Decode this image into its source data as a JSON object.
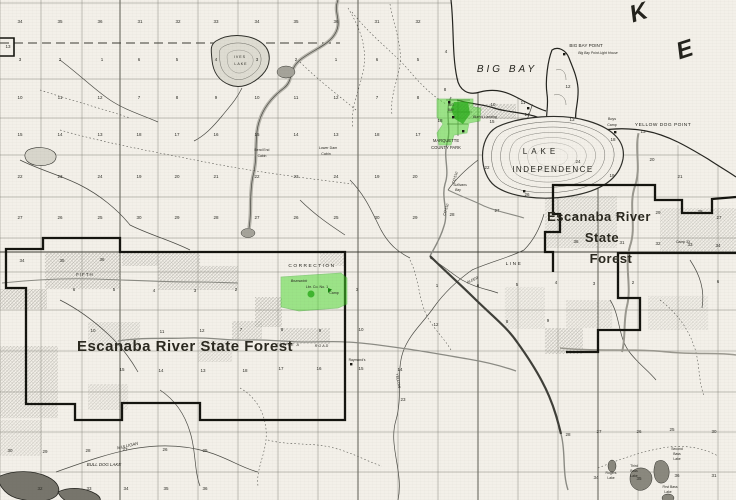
{
  "map": {
    "colors": {
      "paper": "#f3f0e9",
      "ink": "#26251f",
      "highlight_green": "#46d728",
      "highlight_green_dark": "#28aa19",
      "boundary_black": "#14140f",
      "shade_gray": "#8e8d86"
    },
    "labels": [
      {
        "t": "K",
        "x": 641,
        "y": 20,
        "s": 24,
        "it": true,
        "rot": -18,
        "cls": "big"
      },
      {
        "t": "E",
        "x": 687,
        "y": 57,
        "s": 24,
        "it": true,
        "rot": -18,
        "cls": "big"
      },
      {
        "t": "BIG  BAY",
        "x": 507,
        "y": 72,
        "s": 10,
        "it": true,
        "ls": 3
      },
      {
        "t": "BIG BAY POINT",
        "x": 586,
        "y": 47,
        "s": 4.6
      },
      {
        "t": "Big Bay Point Light House",
        "x": 598,
        "y": 54,
        "s": 3.4,
        "it": true
      },
      {
        "t": "Burn's Landing",
        "x": 485,
        "y": 118,
        "s": 3.6,
        "it": true
      },
      {
        "t": "YELLOW DOG POINT",
        "x": 663,
        "y": 126,
        "s": 4.8,
        "ls": 0.5
      },
      {
        "t": "Boys",
        "x": 612,
        "y": 120,
        "s": 3.6
      },
      {
        "t": "Camp",
        "x": 612,
        "y": 126,
        "s": 3.6
      },
      {
        "t": "LAKE",
        "x": 541,
        "y": 154,
        "s": 8,
        "ls": 4
      },
      {
        "t": "INDEPENDENCE",
        "x": 553,
        "y": 172,
        "s": 8,
        "ls": 1.5
      },
      {
        "t": "MARQUETTE",
        "x": 446,
        "y": 142,
        "s": 4.2
      },
      {
        "t": "COUNTY PARK",
        "x": 446,
        "y": 149,
        "s": 4.2
      },
      {
        "t": "Lower Dam",
        "x": 328,
        "y": 149,
        "s": 3.6
      },
      {
        "t": "Cabin",
        "x": 326,
        "y": 155,
        "s": 3.6
      },
      {
        "t": "Bend End",
        "x": 262,
        "y": 151,
        "s": 3.4
      },
      {
        "t": "Cabin",
        "x": 262,
        "y": 157,
        "s": 3.4
      },
      {
        "t": "IVES",
        "x": 240,
        "y": 58,
        "s": 3.6,
        "ls": 1
      },
      {
        "t": "LAKE",
        "x": 241,
        "y": 65,
        "s": 3.6,
        "ls": 1
      },
      {
        "t": "Sullivans",
        "x": 460,
        "y": 186,
        "s": 3.4,
        "it": true
      },
      {
        "t": "Bay",
        "x": 458,
        "y": 191,
        "s": 3.4,
        "it": true
      },
      {
        "t": "CO 510",
        "x": 456,
        "y": 178,
        "s": 3.6,
        "rot": -72
      },
      {
        "t": "CO 510",
        "x": 447,
        "y": 210,
        "s": 3.6,
        "rot": -72
      },
      {
        "t": "CORRECTION",
        "x": 312,
        "y": 267,
        "s": 4.8,
        "ls": 1.5
      },
      {
        "t": "LINE",
        "x": 514,
        "y": 265,
        "s": 4.8,
        "ls": 1.5
      },
      {
        "t": "FIFTH",
        "x": 85,
        "y": 276,
        "s": 4.4,
        "ls": 1
      },
      {
        "t": "Escanaba River State Forest",
        "x": 185,
        "y": 351,
        "s": 15,
        "cls": "forest"
      },
      {
        "t": "Escanaba River",
        "x": 599,
        "y": 221,
        "s": 13,
        "cls": "forest"
      },
      {
        "t": "State",
        "x": 602,
        "y": 242,
        "s": 13,
        "cls": "forest"
      },
      {
        "t": "Forest",
        "x": 611,
        "y": 263,
        "s": 13,
        "cls": "forest"
      },
      {
        "t": "TRIPLE A",
        "x": 288,
        "y": 346,
        "s": 3.6,
        "it": true,
        "ls": 1
      },
      {
        "t": "ROAD",
        "x": 322,
        "y": 347,
        "s": 3.6,
        "it": true,
        "ls": 1
      },
      {
        "t": "Raymond's",
        "x": 357,
        "y": 361,
        "s": 3.4
      },
      {
        "t": "YELLOW",
        "x": 397,
        "y": 381,
        "s": 3.6,
        "rot": 80
      },
      {
        "t": "ALDER",
        "x": 473,
        "y": 281,
        "s": 3.6,
        "it": true,
        "rot": -25
      },
      {
        "t": "MULLIGAN",
        "x": 128,
        "y": 447,
        "s": 4.2,
        "it": true,
        "rot": -13
      },
      {
        "t": "BULL DOG LAKE",
        "x": 104,
        "y": 466,
        "s": 4.4,
        "it": true
      },
      {
        "t": "Rogers",
        "x": 611,
        "y": 474,
        "s": 3.4
      },
      {
        "t": "Lake",
        "x": 611,
        "y": 479,
        "s": 3.4
      },
      {
        "t": "Third",
        "x": 634,
        "y": 467,
        "s": 3.4
      },
      {
        "t": "Bass",
        "x": 634,
        "y": 472,
        "s": 3.4
      },
      {
        "t": "Lake",
        "x": 634,
        "y": 477,
        "s": 3.4
      },
      {
        "t": "Second",
        "x": 677,
        "y": 450,
        "s": 3.4
      },
      {
        "t": "Bass",
        "x": 677,
        "y": 455,
        "s": 3.4
      },
      {
        "t": "Lake",
        "x": 677,
        "y": 460,
        "s": 3.4
      },
      {
        "t": "First Bass",
        "x": 670,
        "y": 488,
        "s": 3.4
      },
      {
        "t": "Lake",
        "x": 668,
        "y": 493,
        "s": 3.4
      },
      {
        "t": "BIG",
        "x": 451,
        "y": 106,
        "s": 3.2
      },
      {
        "t": "BAY",
        "x": 451,
        "y": 111,
        "s": 3.2
      },
      {
        "t": "Brunswick",
        "x": 299,
        "y": 282,
        "s": 3.6,
        "it": true
      },
      {
        "t": "Lbr. Co. No. 1",
        "x": 317,
        "y": 288,
        "s": 3.6
      },
      {
        "t": "Camp",
        "x": 334,
        "y": 294,
        "s": 3.6
      },
      {
        "t": "Camp 33",
        "x": 683,
        "y": 243,
        "s": 3.4
      }
    ],
    "sections": [
      [
        34,
        20,
        23
      ],
      [
        35,
        60,
        23
      ],
      [
        36,
        100,
        23
      ],
      [
        31,
        140,
        23
      ],
      [
        32,
        178,
        23
      ],
      [
        33,
        216,
        23
      ],
      [
        34,
        257,
        23
      ],
      [
        35,
        296,
        23
      ],
      [
        36,
        336,
        23
      ],
      [
        31,
        377,
        23
      ],
      [
        32,
        418,
        23
      ],
      [
        3,
        20,
        61
      ],
      [
        2,
        60,
        61
      ],
      [
        1,
        102,
        61
      ],
      [
        6,
        139,
        61
      ],
      [
        5,
        177,
        61
      ],
      [
        4,
        216,
        61
      ],
      [
        3,
        257,
        61
      ],
      [
        2,
        296,
        61
      ],
      [
        1,
        336,
        61
      ],
      [
        6,
        377,
        61
      ],
      [
        5,
        418,
        61
      ],
      [
        10,
        20,
        99
      ],
      [
        11,
        60,
        99
      ],
      [
        12,
        100,
        99
      ],
      [
        7,
        139,
        99
      ],
      [
        8,
        177,
        99
      ],
      [
        9,
        216,
        99
      ],
      [
        10,
        257,
        99
      ],
      [
        11,
        296,
        99
      ],
      [
        12,
        336,
        99
      ],
      [
        7,
        377,
        99
      ],
      [
        8,
        418,
        99
      ],
      [
        15,
        20,
        136
      ],
      [
        14,
        60,
        136
      ],
      [
        13,
        100,
        136
      ],
      [
        18,
        139,
        136
      ],
      [
        17,
        177,
        136
      ],
      [
        16,
        216,
        136
      ],
      [
        15,
        257,
        136
      ],
      [
        14,
        296,
        136
      ],
      [
        13,
        336,
        136
      ],
      [
        18,
        377,
        136
      ],
      [
        17,
        418,
        136
      ],
      [
        22,
        20,
        178
      ],
      [
        23,
        60,
        178
      ],
      [
        24,
        100,
        178
      ],
      [
        19,
        139,
        178
      ],
      [
        20,
        177,
        178
      ],
      [
        21,
        216,
        178
      ],
      [
        22,
        257,
        178
      ],
      [
        23,
        296,
        178
      ],
      [
        24,
        336,
        178
      ],
      [
        19,
        377,
        178
      ],
      [
        20,
        415,
        178
      ],
      [
        27,
        20,
        219
      ],
      [
        26,
        60,
        219
      ],
      [
        25,
        100,
        219
      ],
      [
        30,
        139,
        219
      ],
      [
        29,
        177,
        219
      ],
      [
        28,
        216,
        219
      ],
      [
        27,
        257,
        219
      ],
      [
        26,
        296,
        219
      ],
      [
        25,
        336,
        219
      ],
      [
        30,
        377,
        219
      ],
      [
        29,
        415,
        219
      ],
      [
        34,
        22,
        262
      ],
      [
        35,
        62,
        262
      ],
      [
        36,
        102,
        261
      ],
      [
        6,
        74,
        291
      ],
      [
        5,
        114,
        291
      ],
      [
        4,
        154,
        292
      ],
      [
        3,
        195,
        292
      ],
      [
        2,
        236,
        291
      ],
      [
        3,
        357,
        291
      ],
      [
        13,
        8,
        48
      ],
      [
        4,
        446,
        53
      ],
      [
        8,
        445,
        91
      ],
      [
        18,
        440,
        122
      ],
      [
        12,
        568,
        88
      ],
      [
        10,
        493,
        106
      ],
      [
        11,
        523,
        104
      ],
      [
        14,
        527,
        116
      ],
      [
        15,
        492,
        123
      ],
      [
        13,
        572,
        121
      ],
      [
        22,
        487,
        169
      ],
      [
        24,
        578,
        163
      ],
      [
        26,
        527,
        196
      ],
      [
        27,
        497,
        212
      ],
      [
        28,
        452,
        216
      ],
      [
        25,
        576,
        218
      ],
      [
        30,
        618,
        216
      ],
      [
        29,
        658,
        214
      ],
      [
        28,
        700,
        213
      ],
      [
        27,
        719,
        219
      ],
      [
        13,
        643,
        133
      ],
      [
        18,
        613,
        141
      ],
      [
        19,
        612,
        177
      ],
      [
        20,
        652,
        161
      ],
      [
        21,
        680,
        178
      ],
      [
        36,
        576,
        243
      ],
      [
        31,
        622,
        244
      ],
      [
        32,
        658,
        245
      ],
      [
        33,
        690,
        246
      ],
      [
        34,
        718,
        247
      ],
      [
        1,
        437,
        287
      ],
      [
        6,
        478,
        287
      ],
      [
        5,
        517,
        286
      ],
      [
        4,
        556,
        284
      ],
      [
        3,
        594,
        285
      ],
      [
        2,
        633,
        284
      ],
      [
        6,
        718,
        283
      ],
      [
        12,
        436,
        326
      ],
      [
        8,
        507,
        323
      ],
      [
        9,
        548,
        322
      ],
      [
        10,
        93,
        332
      ],
      [
        11,
        162,
        333
      ],
      [
        12,
        202,
        332
      ],
      [
        7,
        241,
        331
      ],
      [
        8,
        282,
        331
      ],
      [
        9,
        320,
        332
      ],
      [
        10,
        361,
        331
      ],
      [
        15,
        122,
        371
      ],
      [
        14,
        161,
        372
      ],
      [
        13,
        203,
        372
      ],
      [
        18,
        245,
        372
      ],
      [
        17,
        281,
        370
      ],
      [
        16,
        319,
        370
      ],
      [
        15,
        361,
        370
      ],
      [
        14,
        400,
        371
      ],
      [
        23,
        403,
        401
      ],
      [
        30,
        10,
        452
      ],
      [
        29,
        45,
        453
      ],
      [
        28,
        88,
        452
      ],
      [
        27,
        125,
        451
      ],
      [
        26,
        165,
        451
      ],
      [
        25,
        205,
        452
      ],
      [
        32,
        40,
        490
      ],
      [
        33,
        89,
        490
      ],
      [
        34,
        126,
        490
      ],
      [
        35,
        166,
        490
      ],
      [
        36,
        205,
        490
      ],
      [
        28,
        568,
        436
      ],
      [
        27,
        599,
        433
      ],
      [
        26,
        639,
        433
      ],
      [
        25,
        672,
        431
      ],
      [
        30,
        714,
        433
      ],
      [
        34,
        596,
        479
      ],
      [
        35,
        639,
        480
      ],
      [
        36,
        677,
        477
      ],
      [
        31,
        714,
        477
      ]
    ]
  }
}
